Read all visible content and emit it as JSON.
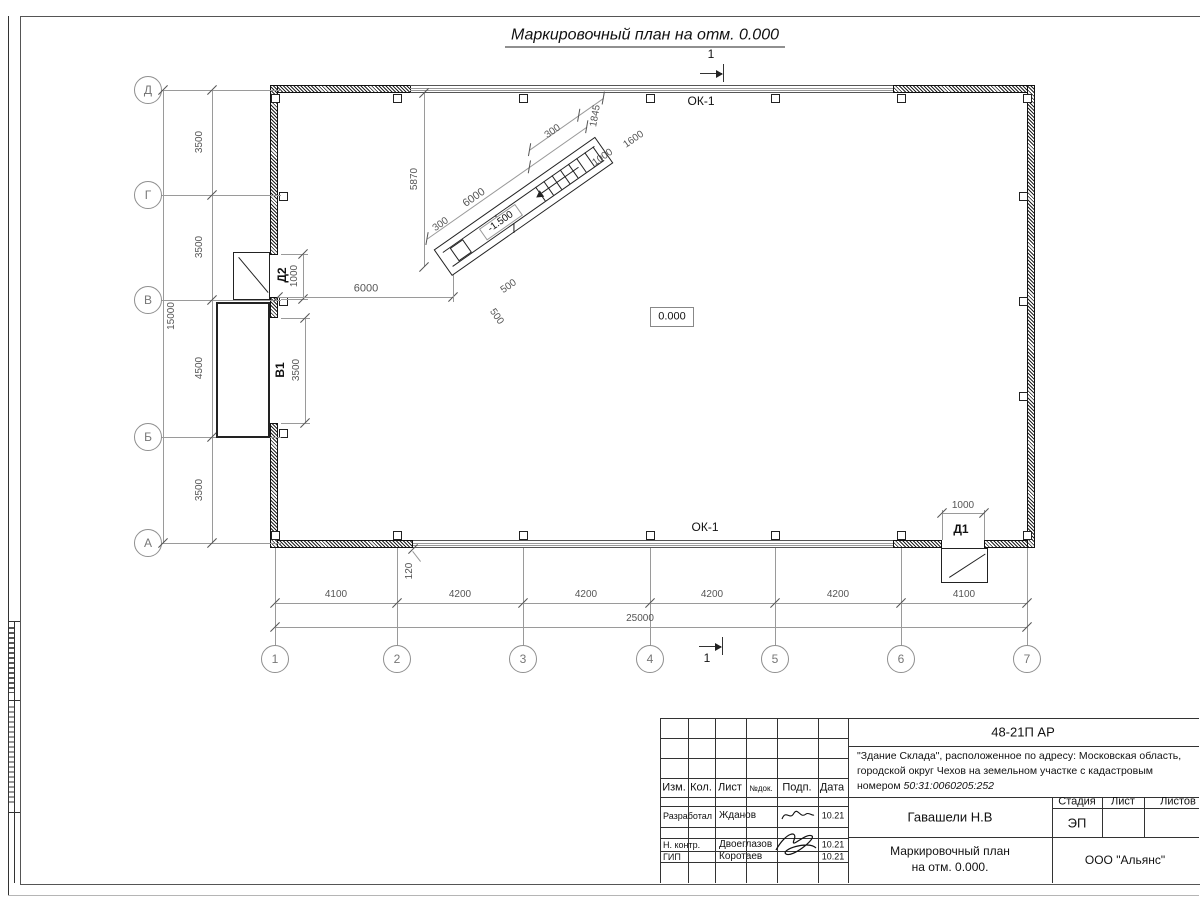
{
  "title": "Маркировочный план на отм. 0.000",
  "plan": {
    "axis_rows": [
      "Д",
      "Г",
      "В",
      "Б",
      "А"
    ],
    "axis_cols": [
      "1",
      "2",
      "3",
      "4",
      "5",
      "6",
      "7"
    ],
    "left_dims": [
      "3500",
      "3500",
      "4500",
      "3500"
    ],
    "left_total": "15000",
    "bottom_dims": [
      "4100",
      "4200",
      "4200",
      "4200",
      "4200",
      "4100"
    ],
    "bottom_total": "25000",
    "window_label_top": "ОК-1",
    "window_label_bottom": "ОК-1",
    "level_zero": "0.000",
    "section_mark": "1",
    "offset_120": "120",
    "wall_to_ramp": "6000"
  },
  "doors": {
    "d1": {
      "label": "Д1",
      "width": "1000"
    },
    "d2": {
      "label": "Д2",
      "width": "1000"
    },
    "v1": {
      "label": "В1",
      "width": "3500"
    }
  },
  "ramp": {
    "level": "-1.500",
    "slope": "6000",
    "height": "5870",
    "run_1845": "1845",
    "dim_1600": "1600",
    "dim_1000": "1000",
    "dim_300_top": "300",
    "dim_300_bottom": "300",
    "dim_500_a": "500",
    "dim_500_b": "500"
  },
  "titleblock": {
    "doc_number": "48-21П АР",
    "desc_line1": "\"Здание Склада\", расположенное по адресу: Московская область,",
    "desc_line2": "городской округ Чехов на земельном участке с кадастровым",
    "desc_line3_prefix": "номером ",
    "cadastral_number": "50:31:0060205:252",
    "headers": {
      "izm": "Изм.",
      "kol": "Кол.",
      "list": "Лист",
      "ndok": "№док.",
      "podp": "Подп.",
      "data": "Дата"
    },
    "rows": [
      {
        "role": "Разработал",
        "name": "Жданов",
        "date": "10.21"
      },
      {
        "role": "Н. контр.",
        "name": "Двоеглазов",
        "date": "10.21"
      },
      {
        "role": "ГИП",
        "name": "Коротаев",
        "date": "10.21"
      }
    ],
    "chief": "Гавашели Н.В",
    "stage_label": "Стадия",
    "sheet_label": "Лист",
    "sheets_label": "Листов",
    "stage_value": "ЭП",
    "drawing_title_line1": "Маркировочный план",
    "drawing_title_line2": "на отм. 0.000.",
    "company": "ООО \"Альянс\""
  }
}
